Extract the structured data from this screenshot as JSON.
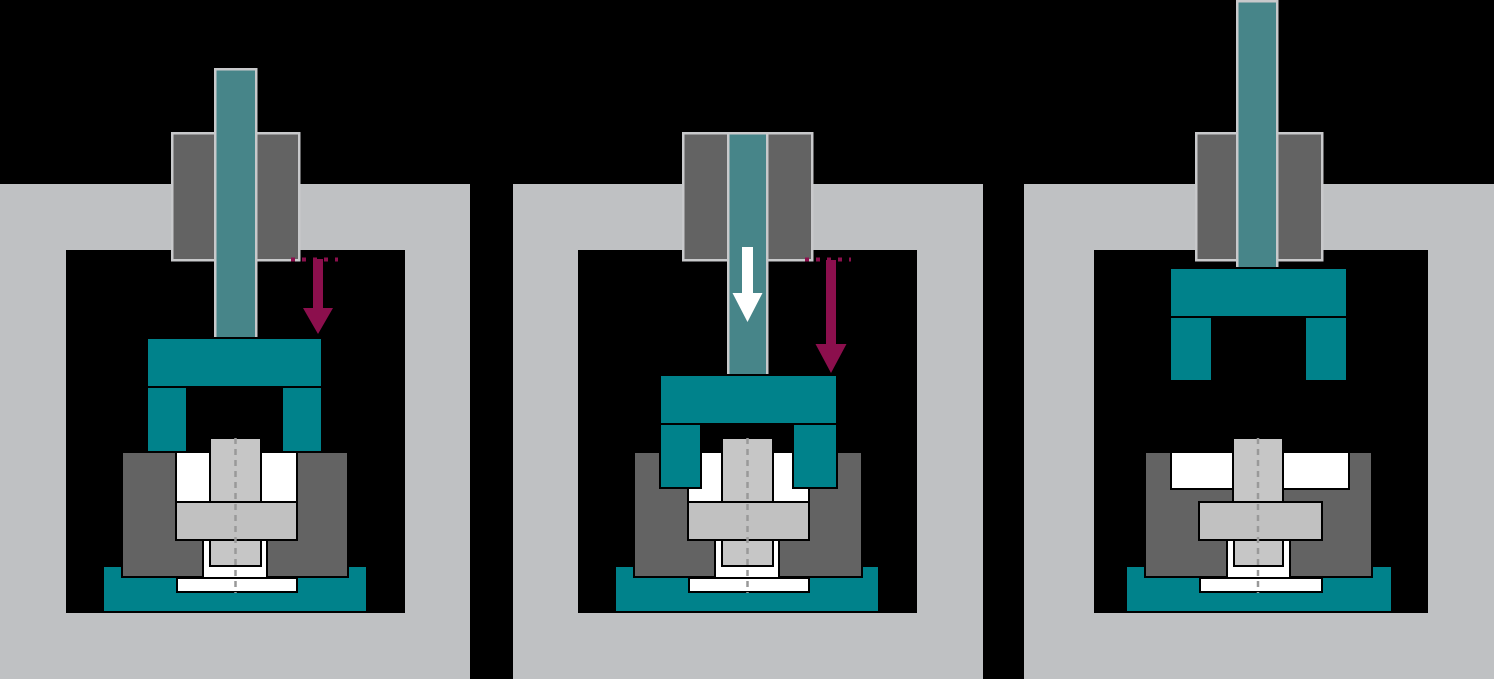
{
  "diagram": {
    "description": "three-stage-press-tooling-sequence",
    "canvas": {
      "width": 1494,
      "height": 679
    },
    "palette": {
      "background": "#000000",
      "frame_gray": "#bfc1c3",
      "machine_gray": "#636363",
      "ram_teal": "#478589",
      "tool_teal": "#00828b",
      "light_border": "#c8c9cb",
      "workpiece_light": "#c6c6c6",
      "flange_gray": "#c1c1c1",
      "white": "#ffffff",
      "outline": "#000000",
      "centerline_gray": "#999999",
      "arrow_maroon": "#8c0f4d",
      "arrow_white": "#ffffff"
    },
    "panels": [
      {
        "name": "stage-1-approach",
        "shapes": [
          {
            "name": "press-frame",
            "type": "rect",
            "x": 0,
            "y": 184,
            "w": 470,
            "h": 495,
            "fill": "frame_gray"
          },
          {
            "name": "frame-window",
            "type": "rect",
            "x": 66,
            "y": 250,
            "w": 339,
            "h": 363,
            "fill": "background"
          },
          {
            "name": "die-base",
            "type": "rect",
            "x": 103,
            "y": 566,
            "w": 264,
            "h": 46,
            "fill": "tool_teal",
            "stroke": "outline",
            "sw": 2
          },
          {
            "name": "die-block",
            "type": "rect",
            "x": 122,
            "y": 452,
            "w": 226,
            "h": 125,
            "fill": "machine_gray",
            "stroke": "outline",
            "sw": 2
          },
          {
            "name": "die-cavity",
            "type": "rect",
            "x": 176,
            "y": 452,
            "w": 121,
            "h": 50,
            "fill": "white",
            "stroke": "outline",
            "sw": 2
          },
          {
            "name": "workpiece-flange",
            "type": "rect",
            "x": 176,
            "y": 502,
            "w": 121,
            "h": 38,
            "fill": "flange_gray",
            "stroke": "outline",
            "sw": 2
          },
          {
            "name": "lower-cavity",
            "type": "rect",
            "x": 203,
            "y": 540,
            "w": 64,
            "h": 38,
            "fill": "white",
            "stroke": "outline",
            "sw": 2
          },
          {
            "name": "workpiece-lower-stem",
            "type": "rect",
            "x": 210,
            "y": 540,
            "w": 51,
            "h": 26,
            "fill": "workpiece_light",
            "stroke": "outline",
            "sw": 2
          },
          {
            "name": "ejector-plate",
            "type": "rect",
            "x": 177,
            "y": 578,
            "w": 120,
            "h": 14,
            "fill": "white",
            "stroke": "outline",
            "sw": 2
          },
          {
            "name": "workpiece-stem",
            "type": "rect",
            "x": 210,
            "y": 438,
            "w": 51,
            "h": 64,
            "fill": "workpiece_light",
            "stroke": "outline",
            "sw": 2
          },
          {
            "name": "centerline",
            "type": "line",
            "x1": 235.5,
            "y1": 438,
            "x2": 235.5,
            "y2": 593,
            "stroke": "centerline_gray",
            "sw": 2.5,
            "dash": "6 5"
          },
          {
            "name": "ram-guide",
            "type": "rect",
            "x": 172,
            "y": 133,
            "w": 127,
            "h": 127,
            "fill": "machine_gray",
            "stroke": "light_border",
            "sw": 2.5
          },
          {
            "name": "ram",
            "type": "rect",
            "x": 215,
            "y": 69,
            "w": 41,
            "h": 269,
            "fill": "ram_teal",
            "stroke": "light_border",
            "sw": 2.5
          },
          {
            "name": "upper-tool-plate",
            "type": "rect",
            "x": 147,
            "y": 338,
            "w": 175,
            "h": 49,
            "fill": "tool_teal",
            "stroke": "outline",
            "sw": 2
          },
          {
            "name": "upper-tool-leg-left",
            "type": "rect",
            "x": 147,
            "y": 387,
            "w": 40,
            "h": 65,
            "fill": "tool_teal",
            "stroke": "outline",
            "sw": 2
          },
          {
            "name": "upper-tool-leg-right",
            "type": "rect",
            "x": 282,
            "y": 387,
            "w": 40,
            "h": 65,
            "fill": "tool_teal",
            "stroke": "outline",
            "sw": 2
          },
          {
            "name": "stroke-reference-dots",
            "type": "line",
            "x1": 291,
            "y1": 259.5,
            "x2": 338,
            "y2": 259.5,
            "stroke": "arrow_maroon",
            "sw": 4,
            "dash": "4 7"
          },
          {
            "name": "stroke-arrow",
            "type": "arrow-down",
            "cx": 318,
            "shaft_w": 10,
            "head_w": 30,
            "y_start": 259,
            "y_tip": 334,
            "head_len": 26,
            "fill": "arrow_maroon"
          }
        ]
      },
      {
        "name": "stage-2-pressing",
        "shapes": [
          {
            "name": "press-frame",
            "type": "rect",
            "x": 513,
            "y": 184,
            "w": 470,
            "h": 495,
            "fill": "frame_gray"
          },
          {
            "name": "frame-window",
            "type": "rect",
            "x": 578,
            "y": 250,
            "w": 339,
            "h": 363,
            "fill": "background"
          },
          {
            "name": "die-base",
            "type": "rect",
            "x": 615,
            "y": 566,
            "w": 264,
            "h": 46,
            "fill": "tool_teal",
            "stroke": "outline",
            "sw": 2
          },
          {
            "name": "die-block",
            "type": "rect",
            "x": 634,
            "y": 452,
            "w": 228,
            "h": 125,
            "fill": "machine_gray",
            "stroke": "outline",
            "sw": 2
          },
          {
            "name": "die-cavity",
            "type": "rect",
            "x": 688,
            "y": 452,
            "w": 121,
            "h": 50,
            "fill": "white",
            "stroke": "outline",
            "sw": 2
          },
          {
            "name": "workpiece-flange",
            "type": "rect",
            "x": 688,
            "y": 502,
            "w": 121,
            "h": 38,
            "fill": "flange_gray",
            "stroke": "outline",
            "sw": 2
          },
          {
            "name": "lower-cavity",
            "type": "rect",
            "x": 715,
            "y": 540,
            "w": 64,
            "h": 38,
            "fill": "white",
            "stroke": "outline",
            "sw": 2
          },
          {
            "name": "workpiece-lower-stem",
            "type": "rect",
            "x": 722,
            "y": 540,
            "w": 51,
            "h": 26,
            "fill": "workpiece_light",
            "stroke": "outline",
            "sw": 2
          },
          {
            "name": "ejector-plate",
            "type": "rect",
            "x": 689,
            "y": 578,
            "w": 120,
            "h": 14,
            "fill": "white",
            "stroke": "outline",
            "sw": 2
          },
          {
            "name": "workpiece-stem",
            "type": "rect",
            "x": 722,
            "y": 438,
            "w": 51,
            "h": 64,
            "fill": "workpiece_light",
            "stroke": "outline",
            "sw": 2
          },
          {
            "name": "centerline",
            "type": "line",
            "x1": 747.5,
            "y1": 438,
            "x2": 747.5,
            "y2": 593,
            "stroke": "centerline_gray",
            "sw": 2.5,
            "dash": "6 5"
          },
          {
            "name": "ram-guide",
            "type": "rect",
            "x": 683,
            "y": 133,
            "w": 129,
            "h": 127,
            "fill": "machine_gray",
            "stroke": "light_border",
            "sw": 2.5
          },
          {
            "name": "ram",
            "type": "rect",
            "x": 728,
            "y": 133,
            "w": 39,
            "h": 242,
            "fill": "ram_teal",
            "stroke": "light_border",
            "sw": 2.5
          },
          {
            "name": "upper-tool-plate",
            "type": "rect",
            "x": 660,
            "y": 375,
            "w": 177,
            "h": 49,
            "fill": "tool_teal",
            "stroke": "outline",
            "sw": 2
          },
          {
            "name": "upper-tool-leg-left",
            "type": "rect",
            "x": 660,
            "y": 424,
            "w": 41,
            "h": 64,
            "fill": "tool_teal",
            "stroke": "outline",
            "sw": 2
          },
          {
            "name": "upper-tool-leg-right",
            "type": "rect",
            "x": 793,
            "y": 424,
            "w": 44,
            "h": 64,
            "fill": "tool_teal",
            "stroke": "outline",
            "sw": 2
          },
          {
            "name": "stroke-reference-dots",
            "type": "line",
            "x1": 805,
            "y1": 259.5,
            "x2": 851,
            "y2": 259.5,
            "stroke": "arrow_maroon",
            "sw": 4,
            "dash": "4 7"
          },
          {
            "name": "stroke-arrow",
            "type": "arrow-down",
            "cx": 831,
            "shaft_w": 10,
            "head_w": 31,
            "y_start": 260,
            "y_tip": 373,
            "head_len": 29,
            "fill": "arrow_maroon"
          },
          {
            "name": "press-force-arrow",
            "type": "arrow-down",
            "cx": 747.5,
            "shaft_w": 11,
            "head_w": 30,
            "y_start": 247,
            "y_tip": 322,
            "head_len": 29,
            "fill": "arrow_white"
          }
        ]
      },
      {
        "name": "stage-3-retracted",
        "shapes": [
          {
            "name": "press-frame",
            "type": "rect",
            "x": 1024,
            "y": 184,
            "w": 470,
            "h": 495,
            "fill": "frame_gray"
          },
          {
            "name": "frame-window",
            "type": "rect",
            "x": 1094,
            "y": 250,
            "w": 334,
            "h": 363,
            "fill": "background"
          },
          {
            "name": "die-base",
            "type": "rect",
            "x": 1126,
            "y": 566,
            "w": 266,
            "h": 46,
            "fill": "tool_teal",
            "stroke": "outline",
            "sw": 2
          },
          {
            "name": "die-block",
            "type": "rect",
            "x": 1145,
            "y": 452,
            "w": 227,
            "h": 125,
            "fill": "machine_gray",
            "stroke": "outline",
            "sw": 2
          },
          {
            "name": "die-cavity",
            "type": "rect",
            "x": 1171,
            "y": 452,
            "w": 178,
            "h": 37,
            "fill": "white",
            "stroke": "outline",
            "sw": 2
          },
          {
            "name": "workpiece-flange",
            "type": "rect",
            "x": 1199,
            "y": 502,
            "w": 123,
            "h": 38,
            "fill": "flange_gray",
            "stroke": "outline",
            "sw": 2
          },
          {
            "name": "lower-cavity",
            "type": "rect",
            "x": 1227,
            "y": 540,
            "w": 63,
            "h": 38,
            "fill": "white",
            "stroke": "outline",
            "sw": 2
          },
          {
            "name": "workpiece-lower-stem",
            "type": "rect",
            "x": 1234,
            "y": 540,
            "w": 49,
            "h": 26,
            "fill": "workpiece_light",
            "stroke": "outline",
            "sw": 2
          },
          {
            "name": "ejector-plate",
            "type": "rect",
            "x": 1200,
            "y": 578,
            "w": 122,
            "h": 14,
            "fill": "white",
            "stroke": "outline",
            "sw": 2
          },
          {
            "name": "workpiece-stem",
            "type": "rect",
            "x": 1233,
            "y": 438,
            "w": 50,
            "h": 64,
            "fill": "workpiece_light",
            "stroke": "outline",
            "sw": 2
          },
          {
            "name": "centerline",
            "type": "line",
            "x1": 1258,
            "y1": 438,
            "x2": 1258,
            "y2": 593,
            "stroke": "centerline_gray",
            "sw": 2.5,
            "dash": "6 5"
          },
          {
            "name": "ram-guide",
            "type": "rect",
            "x": 1196,
            "y": 133,
            "w": 126,
            "h": 127,
            "fill": "machine_gray",
            "stroke": "light_border",
            "sw": 2.5
          },
          {
            "name": "ram",
            "type": "rect",
            "x": 1237,
            "y": 1,
            "w": 40,
            "h": 267,
            "fill": "ram_teal",
            "stroke": "light_border",
            "sw": 2.5
          },
          {
            "name": "upper-tool-plate",
            "type": "rect",
            "x": 1170,
            "y": 268,
            "w": 177,
            "h": 49,
            "fill": "tool_teal",
            "stroke": "outline",
            "sw": 2
          },
          {
            "name": "upper-tool-leg-left",
            "type": "rect",
            "x": 1170,
            "y": 317,
            "w": 42,
            "h": 64,
            "fill": "tool_teal",
            "stroke": "outline",
            "sw": 2
          },
          {
            "name": "upper-tool-leg-right",
            "type": "rect",
            "x": 1305,
            "y": 317,
            "w": 42,
            "h": 64,
            "fill": "tool_teal",
            "stroke": "outline",
            "sw": 2
          }
        ]
      }
    ]
  }
}
